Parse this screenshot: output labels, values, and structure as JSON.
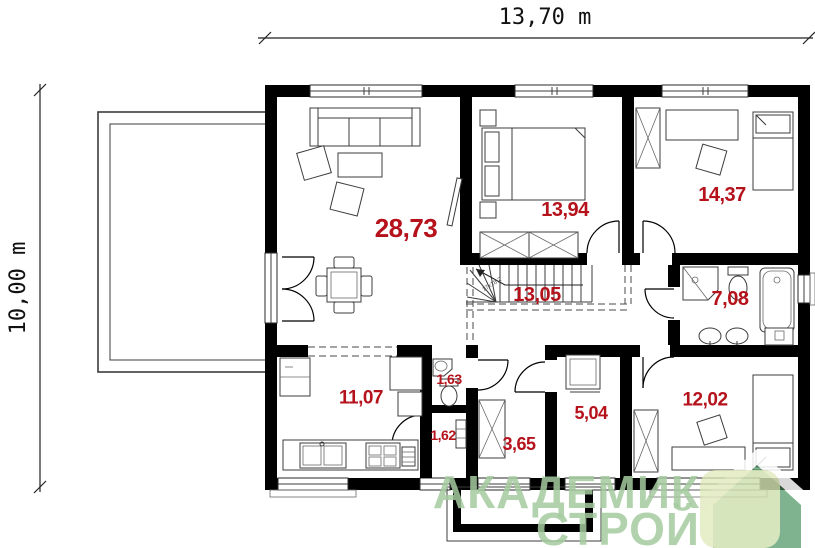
{
  "dimensions": {
    "width": "13,70 m",
    "height": "10,00 m"
  },
  "rooms": {
    "living": {
      "area": "28,73"
    },
    "bedroom1": {
      "area": "13,94"
    },
    "bedroom2": {
      "area": "14,37"
    },
    "bathroom": {
      "area": "7,08"
    },
    "hall": {
      "area": "13,05"
    },
    "wc": {
      "area": "1,63"
    },
    "kitchen": {
      "area": "11,07"
    },
    "lobby": {
      "area": "1,62"
    },
    "entry": {
      "area": "3,65"
    },
    "utility": {
      "area": "5,04"
    },
    "bedroom3": {
      "area": "12,02"
    }
  },
  "stairs": {
    "note": "17x18,2"
  },
  "watermark": {
    "line1": "АКАДЕМИК",
    "line2": "СТРОЙ"
  },
  "colors": {
    "wall": "#000000",
    "area_label": "#b5121c",
    "watermark_green": "#a5cb9f",
    "logo_green": "#44905c",
    "logo_yellow": "#dfe8b8"
  }
}
